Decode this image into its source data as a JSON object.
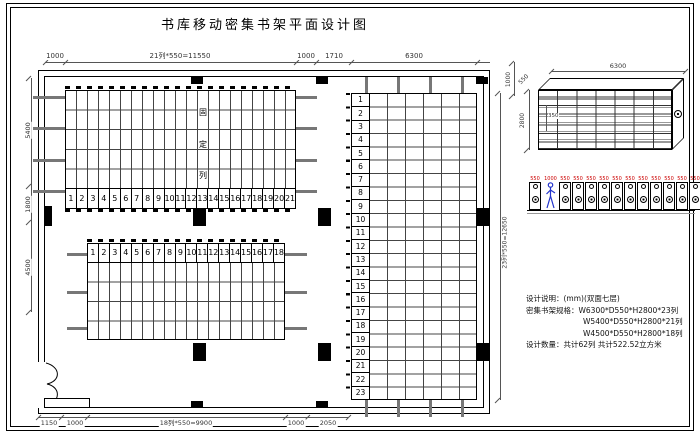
{
  "sheet": {
    "title": "书库移动密集书架平面设计图"
  },
  "plan": {
    "dims_top": {
      "d1": "1000",
      "d2": "21列*550=11550",
      "d3": "1000",
      "d4": "1710",
      "d5": "6300"
    },
    "dims_bottom": {
      "d1": "1150",
      "d2": "1000",
      "d3": "18列*550=9900",
      "d4": "1000",
      "d5": "2050"
    },
    "dims_left": {
      "d1": "5400",
      "d2": "1800",
      "d3": "4500"
    },
    "dim_right": "23列*550=12650",
    "block_top": {
      "numbers": [
        "1",
        "2",
        "3",
        "4",
        "5",
        "6",
        "7",
        "8",
        "9",
        "10",
        "11",
        "12",
        "13",
        "14",
        "15",
        "16",
        "17",
        "18",
        "19",
        "20",
        "21"
      ],
      "fixed_label_chars": [
        "固",
        "定",
        "列"
      ]
    },
    "block_middle": {
      "numbers": [
        "1",
        "2",
        "3",
        "4",
        "5",
        "6",
        "7",
        "8",
        "9",
        "10",
        "11",
        "12",
        "13",
        "14",
        "15",
        "16",
        "17",
        "18"
      ]
    },
    "block_right": {
      "numbers": [
        "1",
        "2",
        "3",
        "4",
        "5",
        "6",
        "7",
        "8",
        "9",
        "10",
        "11",
        "12",
        "13",
        "14",
        "15",
        "16",
        "17",
        "18",
        "19",
        "20",
        "21",
        "22",
        "23"
      ]
    }
  },
  "elevation": {
    "dim_width": "6300",
    "dim_height": "2800",
    "dim_depth": "550",
    "dim_offset": "1000",
    "dim_shelf": "350"
  },
  "section": {
    "unit_dims": [
      "550",
      "550",
      "550",
      "550",
      "550",
      "550",
      "550",
      "550",
      "550",
      "550",
      "550",
      "550"
    ],
    "aisle_dim": "1000"
  },
  "notes": {
    "line1": "设计说明：(mm)(双面七层)",
    "line2": "密集书架规格：W6300*D550*H2800*23列",
    "line3": "W5400*D550*H2800*21列",
    "line4": "W4500*D550*H2800*18列",
    "line5": "设计数量：共计62列  共计522.52立方米"
  }
}
